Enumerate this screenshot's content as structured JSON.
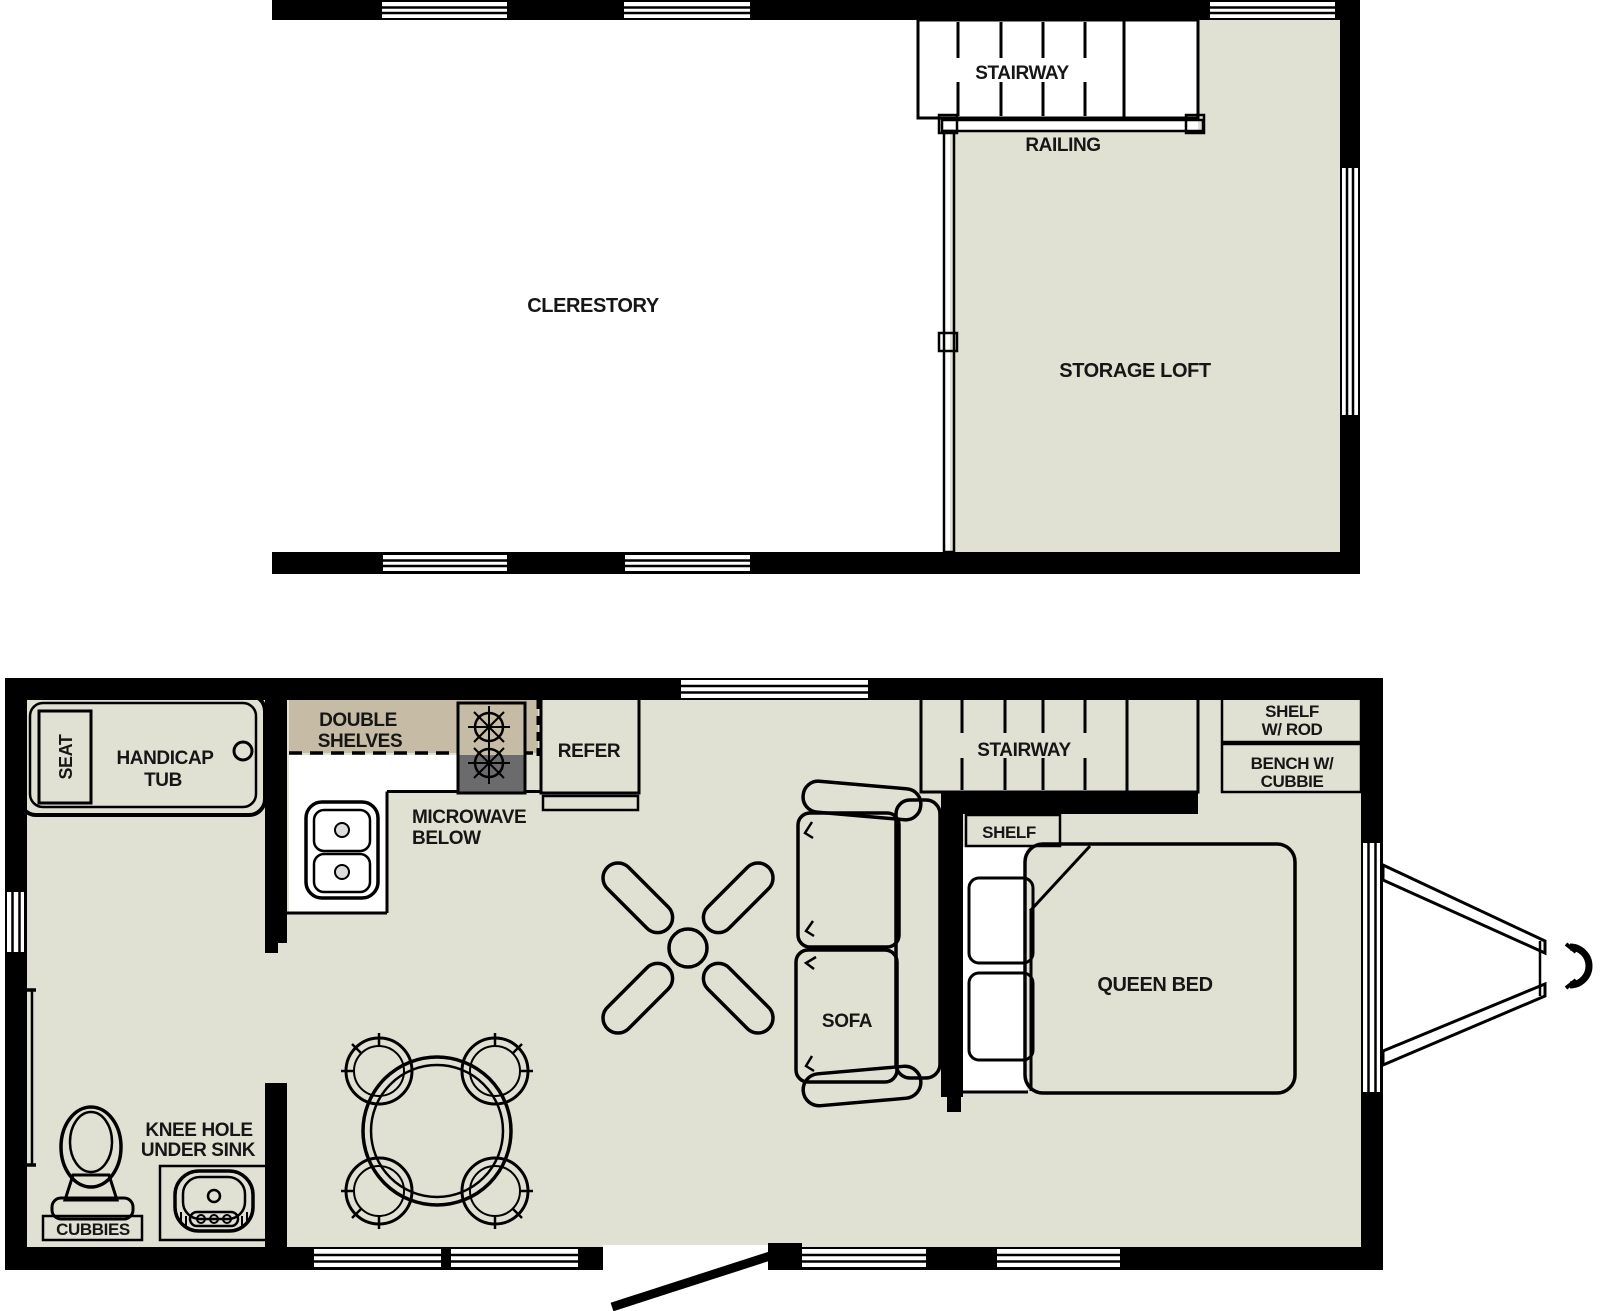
{
  "colors": {
    "floor": "#e1e1d3",
    "tan": "#c6bba4",
    "appliance": "#6b6b6d",
    "wall": "#000000"
  },
  "upper_floor": {
    "labels": {
      "clerestory": "CLERESTORY",
      "stairway": "STAIRWAY",
      "railing": "RAILING",
      "storage_loft": "STORAGE LOFT"
    }
  },
  "main_floor": {
    "labels": {
      "seat": "SEAT",
      "handicap_tub_line1": "HANDICAP",
      "handicap_tub_line2": "TUB",
      "double_shelves_line1": "DOUBLE",
      "double_shelves_line2": "SHELVES",
      "microwave_line1": "MICROWAVE",
      "microwave_line2": "BELOW",
      "refer": "REFER",
      "stairway": "STAIRWAY",
      "shelf_w_rod_line1": "SHELF",
      "shelf_w_rod_line2": "W/ ROD",
      "bench_line1": "BENCH W/",
      "bench_line2": "CUBBIE",
      "shelf": "SHELF",
      "queen_bed": "QUEEN BED",
      "sofa": "SOFA",
      "knee_hole_line1": "KNEE HOLE",
      "knee_hole_line2": "UNDER SINK",
      "cubbies": "CUBBIES"
    }
  }
}
